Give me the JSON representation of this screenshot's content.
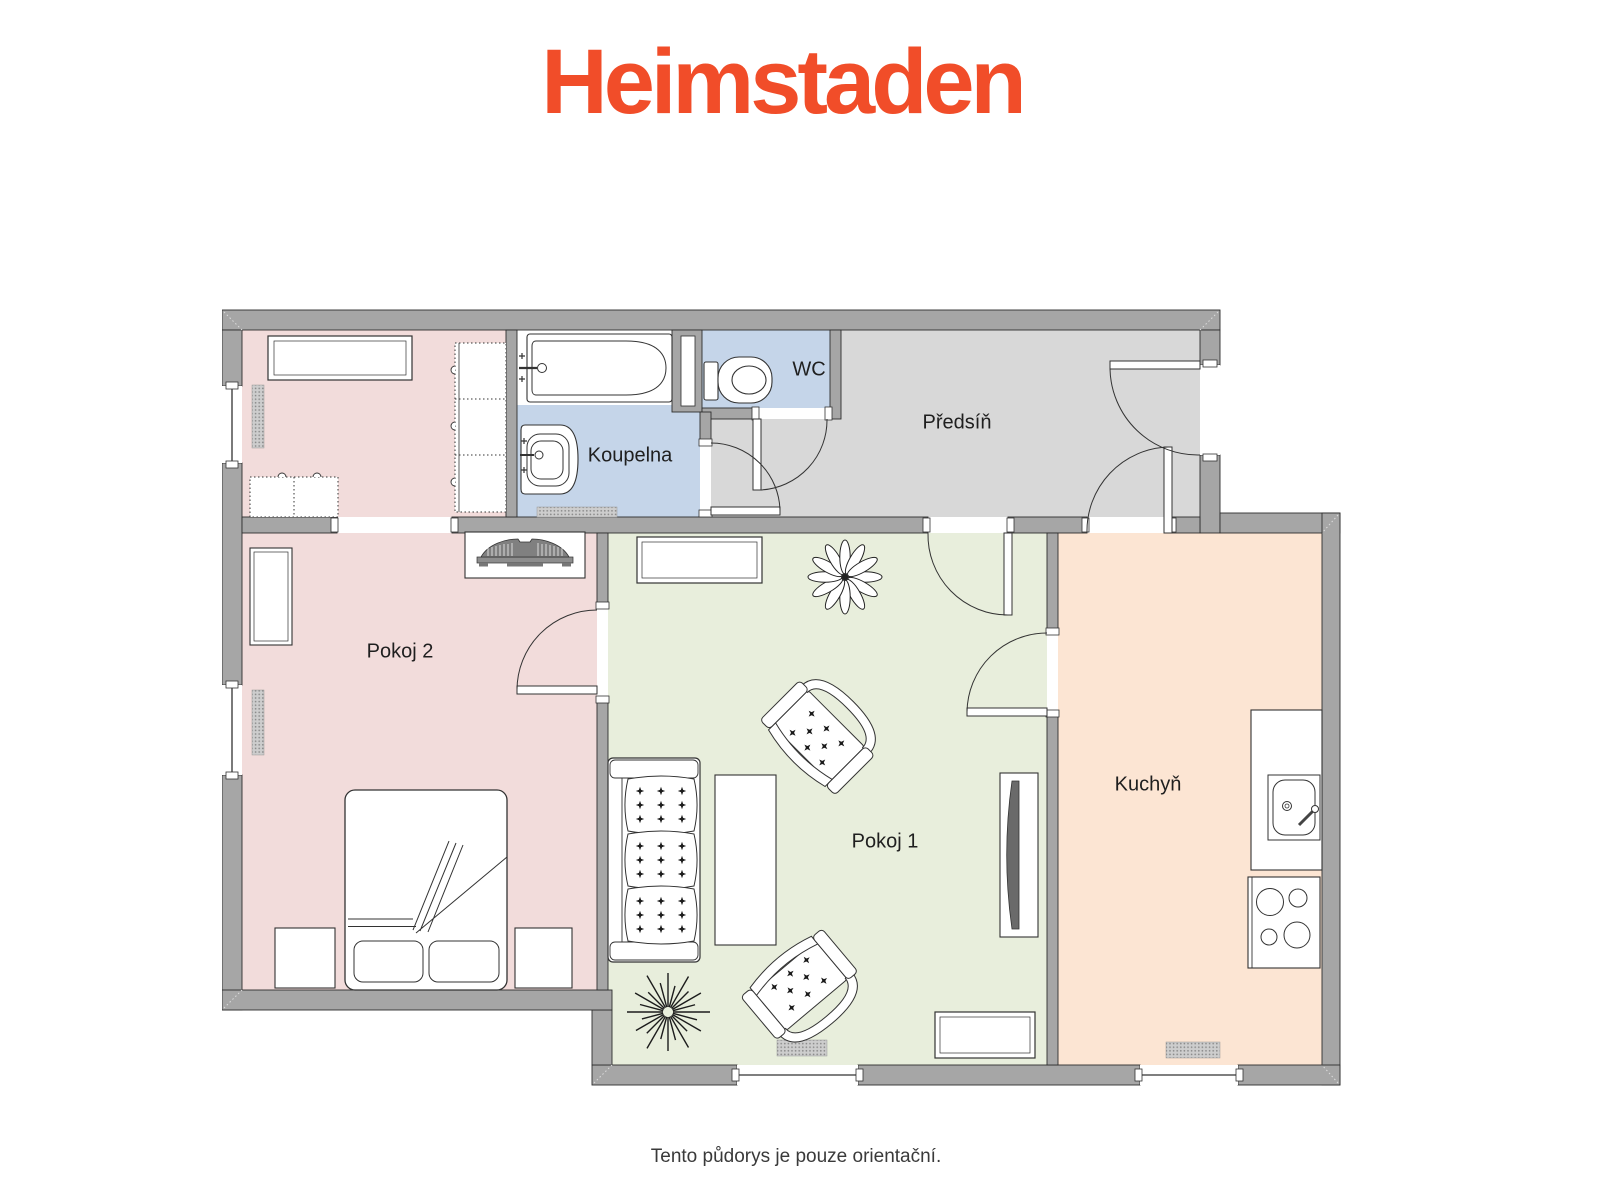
{
  "logo": {
    "text": "Heimstaden"
  },
  "footer": {
    "disclaimer": "Tento půdorys je pouze orientační."
  },
  "rooms": {
    "pokoj2": {
      "label": "Pokoj 2"
    },
    "pokoj1": {
      "label": "Pokoj 1"
    },
    "koupelna": {
      "label": "Koupelna"
    },
    "wc": {
      "label": "WC"
    },
    "predsin": {
      "label": "Předsíň"
    },
    "kuchyn": {
      "label": "Kuchyň"
    }
  },
  "colors": {
    "logo": "#F14D29",
    "wall": "#A6A6A6",
    "floor_bedroom": "#F2DCDB",
    "floor_living": "#E8EEDC",
    "floor_bathroom": "#C5D5E9",
    "floor_wc": "#C5D5E9",
    "floor_hallway": "#D8D8D8",
    "floor_kitchen": "#FCE5D3",
    "caption_text": "#3a3a3a",
    "label_text": "#1f1f1f"
  },
  "icons": {
    "bathtub-icon": "rounded-end tub outline with tap",
    "washbasin-icon": "nested rounded basin with tap",
    "toilet-icon": "cistern + oval bowl",
    "bed-icon": "double bed, two pillows, folded blanket",
    "nightstand-icon": "square table",
    "wardrobe-icon": "dashed-outline cabinet with knobs",
    "piano-icon": "keyboard on shelf",
    "dresser-icon": "double-border rectangle",
    "sofa-icon": "three-seat tufted sofa",
    "armchair-icon": "tufted armchair",
    "coffee-table-icon": "rectangle table",
    "tv-icon": "flat screen on sideboard",
    "plant-leafy-icon": "12-petal plant",
    "plant-spiky-icon": "starburst plant",
    "kitchen-sink-icon": "counter sink with tap",
    "stove-icon": "4-burner hob",
    "radiator-icon": "hatched bar",
    "door-icon": "leaf with quarter-circle swing",
    "window-icon": "wall gap with center line"
  }
}
